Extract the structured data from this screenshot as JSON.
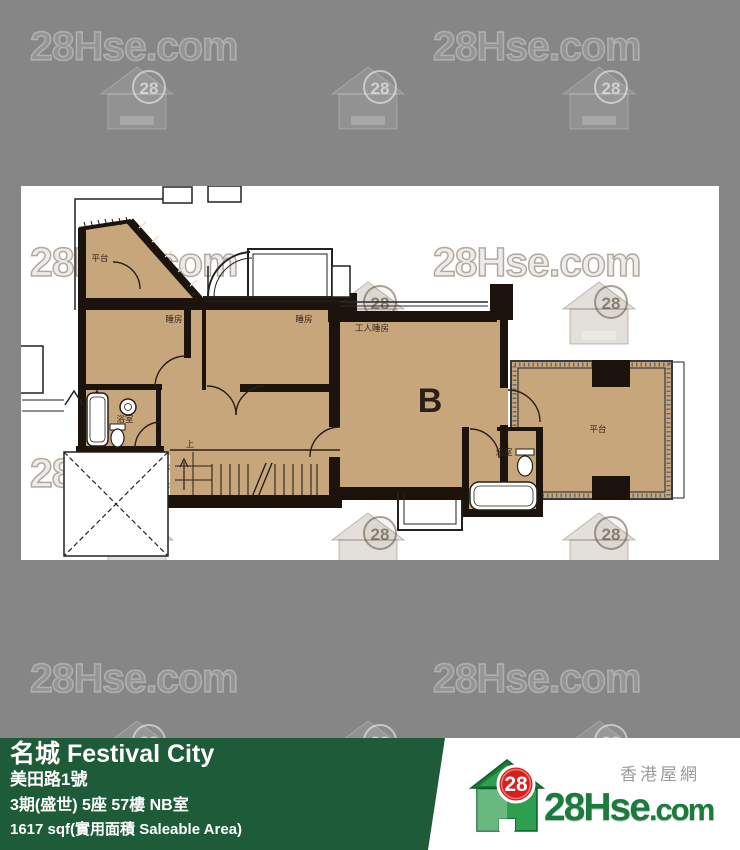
{
  "watermark": {
    "text": "28Hse.com",
    "badge": "28"
  },
  "floorplan": {
    "unit_letter": "B",
    "labels": {
      "terrace_top": "平台",
      "bedroom1": "睡房",
      "bedroom2": "睡房",
      "servant_room": "工人睡房",
      "bathroom1": "浴室",
      "bathroom2": "浴室",
      "terrace_right": "平台",
      "stairs_up": "上"
    }
  },
  "info_bar": {
    "building_name": "名城 Festival City",
    "address": "美田路1號",
    "unit": "3期(盛世) 5座 57樓 NB室",
    "area": "1617 sqf(實用面積 Saleable Area)"
  },
  "logo": {
    "tagline": "香港屋網",
    "brand": "28Hse",
    "brand_suffix": ".com",
    "badge": "28"
  },
  "colors": {
    "background": "#868686",
    "floor_fill": "#c8a67c",
    "wall": "#1c140c",
    "bar_green": "#1e5b39",
    "brand_green": "#1b7a3c",
    "badge_red": "#d62020"
  }
}
